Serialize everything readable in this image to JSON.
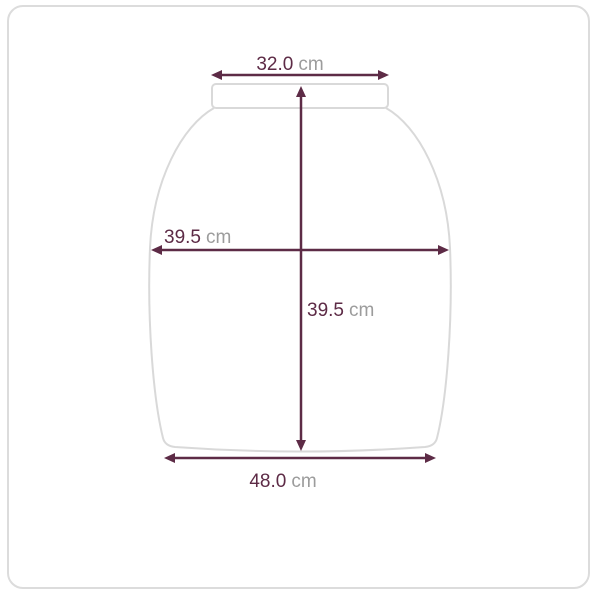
{
  "measurements": {
    "top_width": {
      "value": "32.0",
      "unit": "cm"
    },
    "mid_width": {
      "value": "39.5",
      "unit": "cm"
    },
    "length": {
      "value": "39.5",
      "unit": "cm"
    },
    "bottom_width": {
      "value": "48.0",
      "unit": "cm"
    }
  },
  "colors": {
    "measure_line": "#5d2b46",
    "value_text": "#5d2b46",
    "unit_text": "#9c9c9c",
    "garment_outline": "#d9d9d9",
    "frame_border": "#dcdcdc",
    "background": "#ffffff"
  }
}
